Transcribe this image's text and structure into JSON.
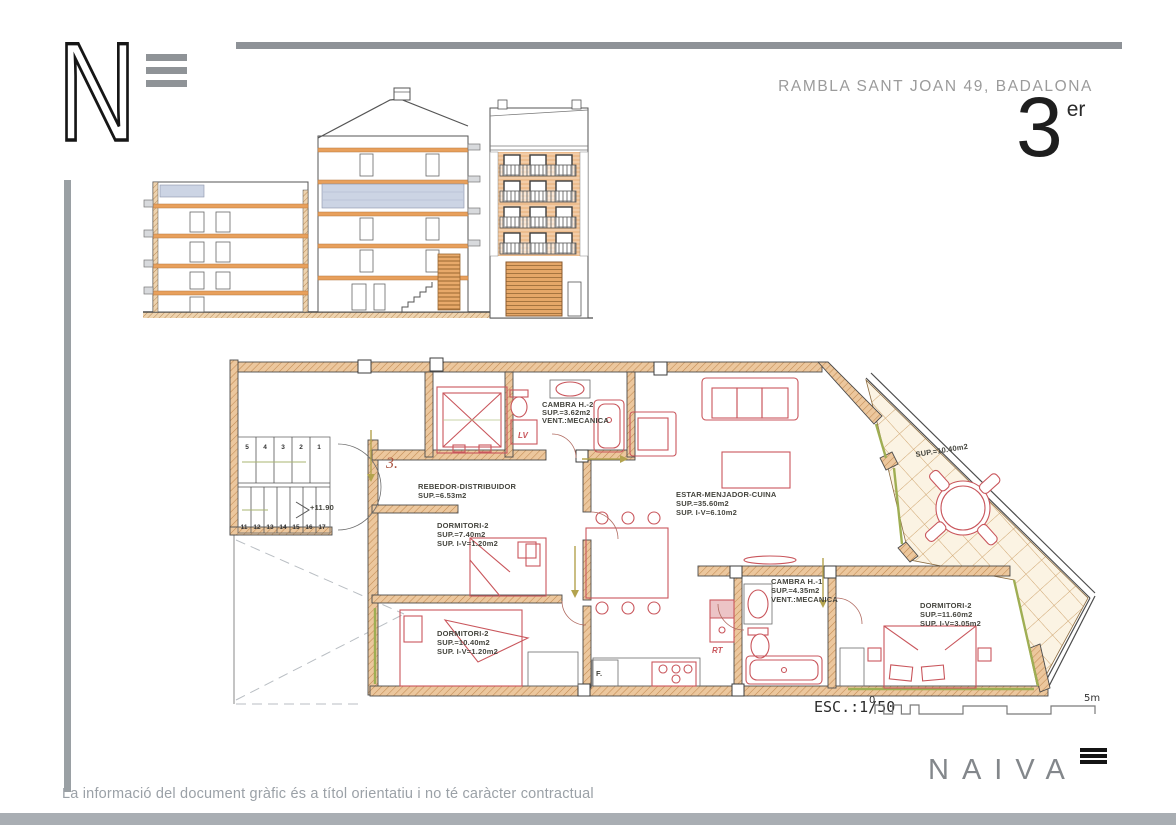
{
  "header": {
    "address": "RAMBLA SANT JOAN 49, BADALONA",
    "floor_number": "3",
    "floor_suffix": "er"
  },
  "logo": {
    "letter": "N"
  },
  "plan": {
    "drawing_number": "3.",
    "level_mark": "+11.90",
    "scale": {
      "label": "ESC.:1/50",
      "start": "0",
      "end": "5m"
    },
    "stairs": {
      "upper": [
        "5",
        "4",
        "3",
        "2",
        "1"
      ],
      "lower": [
        "11",
        "12",
        "13",
        "14",
        "15",
        "16",
        "17"
      ]
    },
    "appliances": {
      "washer": "LV",
      "sink_unit": "RT",
      "fridge": "F."
    },
    "rooms": {
      "cambra_h2": {
        "lines": [
          "CAMBRA H.-2",
          "SUP.=3.62m2",
          "VENT.:MECANICA"
        ]
      },
      "rebedor": {
        "lines": [
          "REBEDOR-DISTRIBUIDOR",
          "SUP.=6.53m2"
        ]
      },
      "dormitori_sw": {
        "lines": [
          "DORMITORI-2",
          "SUP.=7.40m2",
          "SUP. I-V=1.20m2"
        ]
      },
      "estar": {
        "lines": [
          "ESTAR-MENJADOR-CUINA",
          "SUP.=35.60m2",
          "SUP. I-V=6.10m2"
        ]
      },
      "terrassa": {
        "lines": [
          "SUP.=10.40m2"
        ]
      },
      "cambra_h1": {
        "lines": [
          "CAMBRA H.-1",
          "SUP.=4.35m2",
          "VENT.:MECANICA"
        ]
      },
      "dormitori_s": {
        "lines": [
          "DORMITORI-2",
          "SUP.=10.40m2",
          "SUP. I-V=1.20m2"
        ]
      },
      "dormitori_se": {
        "lines": [
          "DORMITORI-2",
          "SUP.=11.60m2",
          "SUP. I-V=3.05m2"
        ]
      }
    }
  },
  "footer": {
    "disclaimer": "La informació del document gràfic és a títol orientatiu i no té caràcter contractual"
  },
  "brand": {
    "name": "NAIVA"
  },
  "colors": {
    "wall_fill": "#ecc79d",
    "wall_hatch": "#c28a52",
    "furniture_red": "#c9565c",
    "window_green": "#9fae53",
    "terrace_tile": "#cfa570",
    "glазing_blue": "#ccd4e4",
    "frame_gray": "#8e9297",
    "text_gray": "#9b9b9b"
  }
}
